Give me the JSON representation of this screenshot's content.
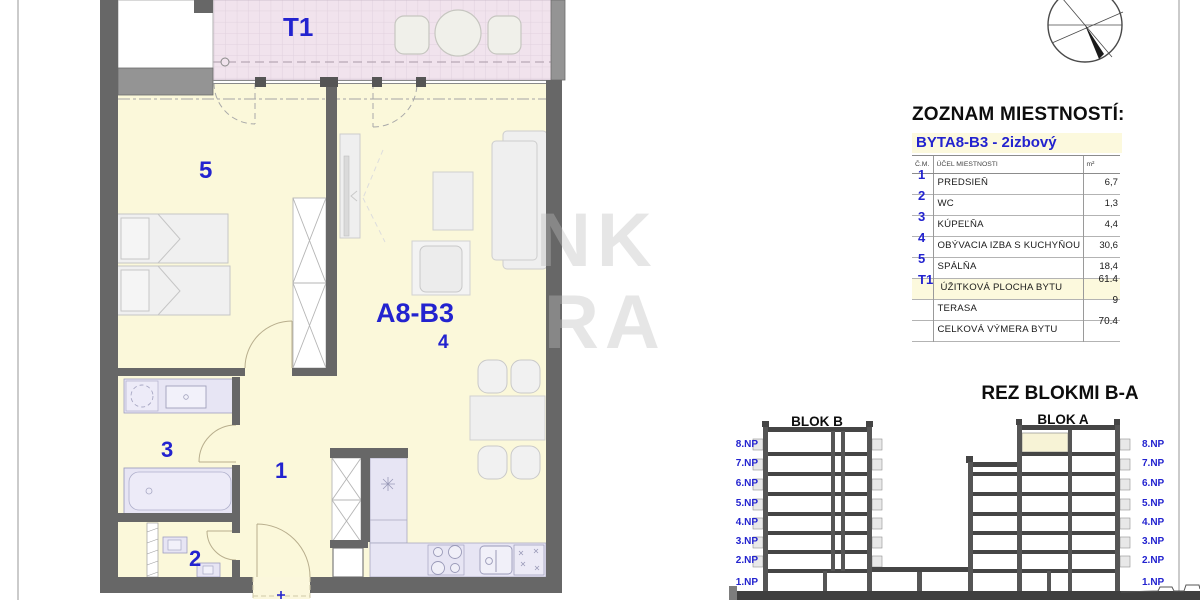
{
  "plan": {
    "terrace_label": "T1",
    "apartment_label": "A8-B3",
    "room_labels": {
      "hall": "1",
      "wc": "2",
      "bath": "3",
      "living": "4",
      "bedroom": "5"
    },
    "entry_mark": "+"
  },
  "room_list": {
    "title": "ZOZNAM MIESTNOSTÍ:",
    "subtitle": "BYTA8-B3 - 2izbový",
    "headers": {
      "num": "Č.M.",
      "purpose": "ÚČEL MIESTNOSTI",
      "area": "m²"
    },
    "rows": [
      {
        "num": "1",
        "name": "PREDSIEŇ",
        "area": "6,7"
      },
      {
        "num": "2",
        "name": "WC",
        "area": "1,3"
      },
      {
        "num": "3",
        "name": "KÚPEĽŇA",
        "area": "4,4"
      },
      {
        "num": "4",
        "name": "OBÝVACIA IZBA S KUCHYŇOU",
        "area": "30,6"
      },
      {
        "num": "5",
        "name": "SPÁLŇA",
        "area": "18,4"
      }
    ],
    "summary": [
      {
        "num": "T1",
        "name": "ÚŽITKOVÁ PLOCHA BYTU",
        "area": "61.4"
      },
      {
        "num": "",
        "name": "TERASA",
        "area": "9"
      },
      {
        "num": "",
        "name": "CELKOVÁ VÝMERA BYTU",
        "area": "70.4"
      }
    ]
  },
  "section_view": {
    "title": "REZ BLOKMI B-A",
    "block_b": "BLOK B",
    "block_a": "BLOK A",
    "floors": [
      "8.NP",
      "7.NP",
      "6.NP",
      "5.NP",
      "4.NP",
      "3.NP",
      "2.NP",
      "1.NP"
    ]
  },
  "watermark": {
    "line1": "NK",
    "line2": "RA"
  },
  "colors": {
    "accent_blue": "#2323cf",
    "floor_yellow": "#fbf8da",
    "terrace_pink": "#f1e3ed",
    "fixture_lavender": "#e7e5f4",
    "wall_dark": "#676767",
    "highlight_row": "#fcf9dd"
  }
}
